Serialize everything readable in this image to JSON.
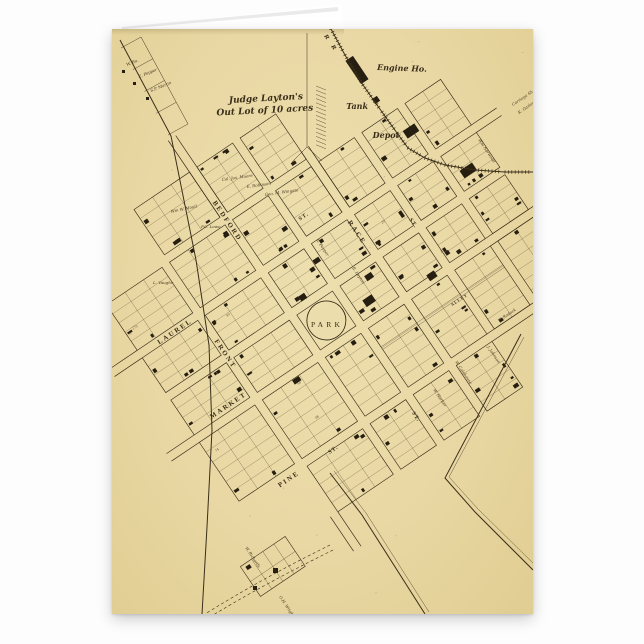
{
  "page": {
    "background": "#fdfdfd"
  },
  "card": {
    "kind": "folded greeting card with vintage town map",
    "paper_color": "#e9d8a4",
    "ink_color": "#3a2e1a",
    "building_color": "#261e11",
    "inside_page_color": "#ffffff"
  },
  "map": {
    "out_lot_note": {
      "line1": "Judge Layton's",
      "line2": "Out Lot of 10 acres"
    },
    "park_label": "PARK",
    "railroad": {
      "rr_label": "R  R",
      "engine_house": "Engine Ho.",
      "tank": "Tank",
      "depot": "Depot"
    },
    "streets": {
      "bedford": "BEDFORD",
      "race": "RACE",
      "laurel": "LAUREL",
      "front": "FRONT",
      "market": "MARKET",
      "pine": "PINE",
      "st_suffix": "ST.",
      "alley": "ALLEY"
    },
    "owners": [
      "W. Ba.",
      "E. Pepper",
      "S.P. Martin",
      "Wm W. Moull",
      "P.C. Lowe",
      "Col. Jos. Moore",
      "E. Robinson",
      "Geo. M. Wingate",
      "L. Vaughn",
      "R. Pepper",
      "R. Layton",
      "Wm Norwood",
      "Carriage Sh.",
      "K. Garland",
      "W. Colehouse",
      "J. Johnson",
      "W. Rodock",
      "W. Richards",
      "G.H. Wright",
      "W. Harber"
    ],
    "lot_numbers": [
      "170",
      "171",
      "49",
      "58",
      "74",
      "25",
      "29",
      "86"
    ]
  }
}
